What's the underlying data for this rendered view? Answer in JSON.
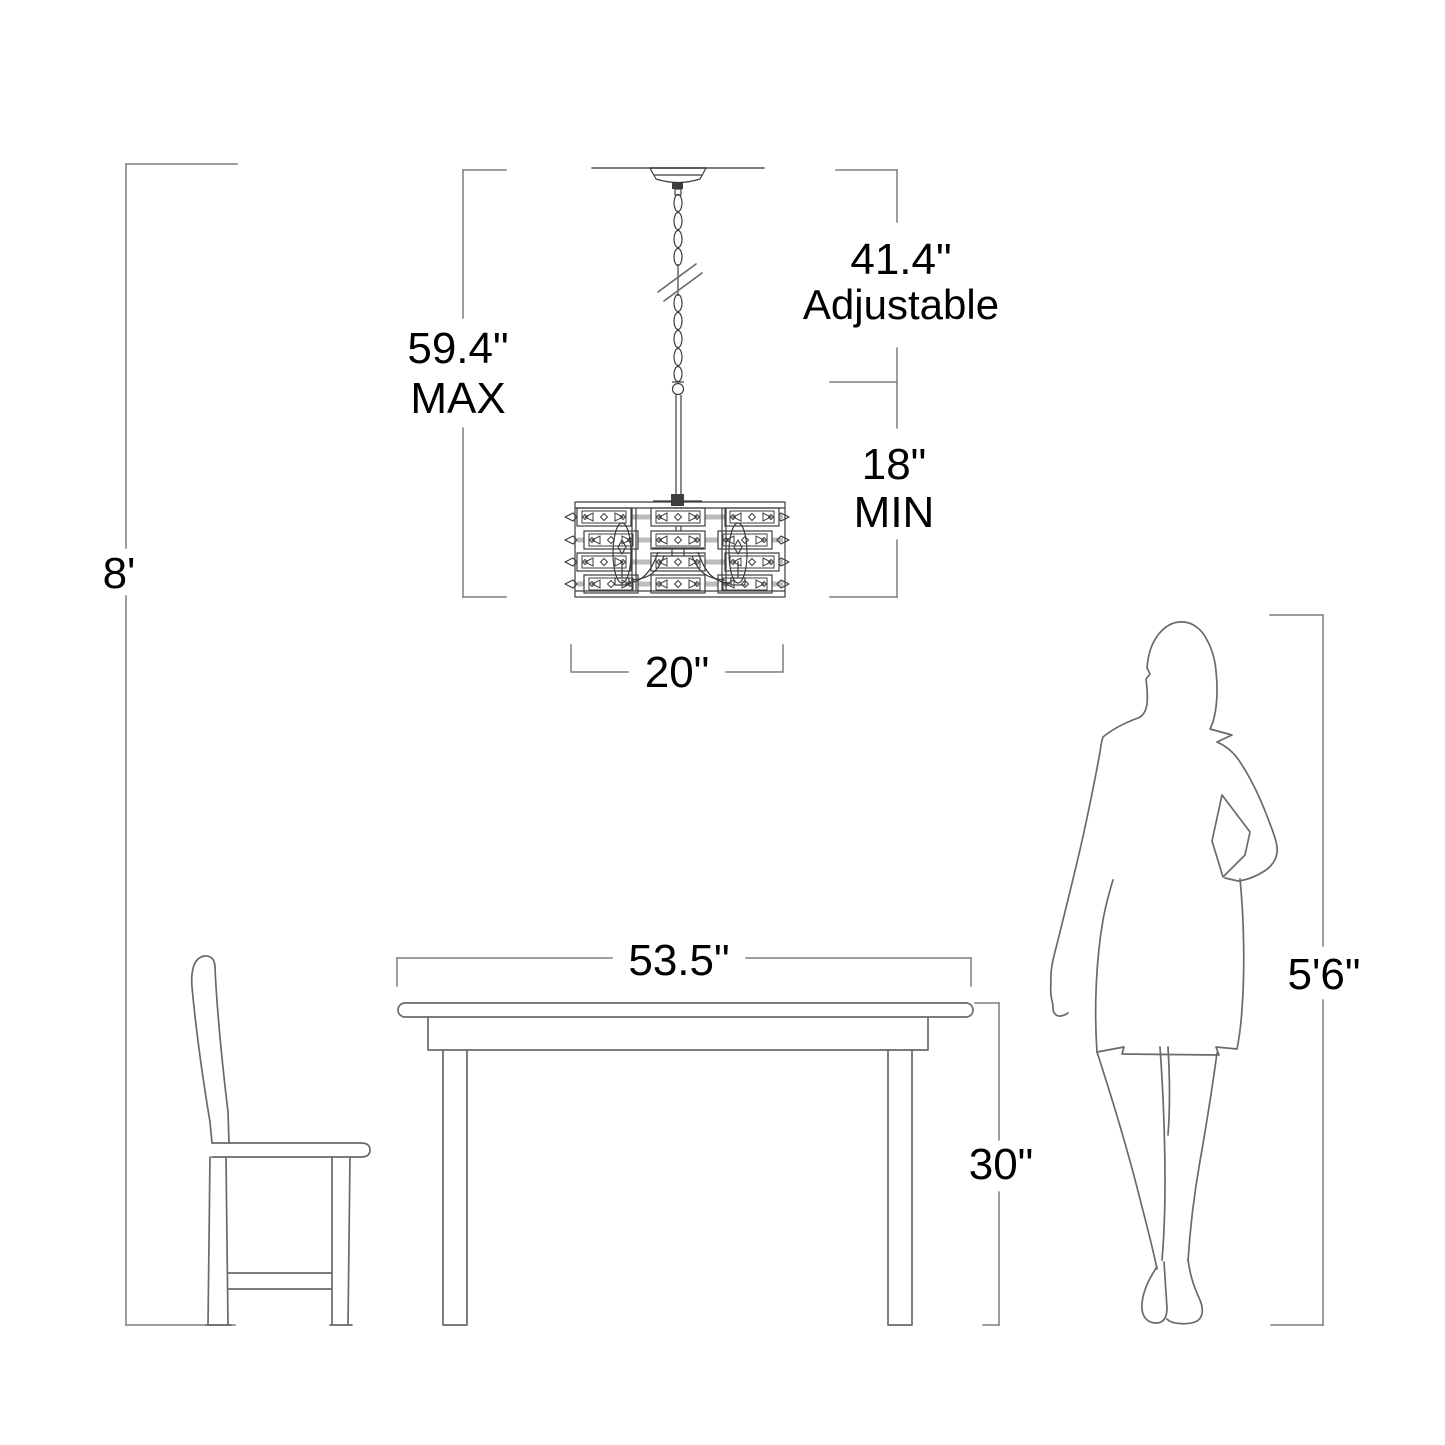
{
  "diagram": {
    "type": "product-dimension-diagram",
    "subject": "chandelier hanging height diagram with dining table, chair and person for scale",
    "colors": {
      "background": "#ffffff",
      "line": "#6a6a6a",
      "dimension_line": "#7e7e7e",
      "text": "#000000",
      "shade": "#bcbcbc",
      "fixture": "#3d3d3d"
    },
    "dimensions": {
      "ceiling_height": {
        "value": "8'"
      },
      "max_drop": {
        "value": "59.4\"",
        "qualifier": "MAX"
      },
      "adjustable_range": {
        "value": "41.4\"",
        "qualifier": "Adjustable"
      },
      "min_drop": {
        "value": "18\"",
        "qualifier": "MIN"
      },
      "fixture_width": {
        "value": "20\""
      },
      "table_width": {
        "value": "53.5\""
      },
      "table_height": {
        "value": "30\""
      },
      "person_height": {
        "value": "5'6\""
      }
    }
  }
}
